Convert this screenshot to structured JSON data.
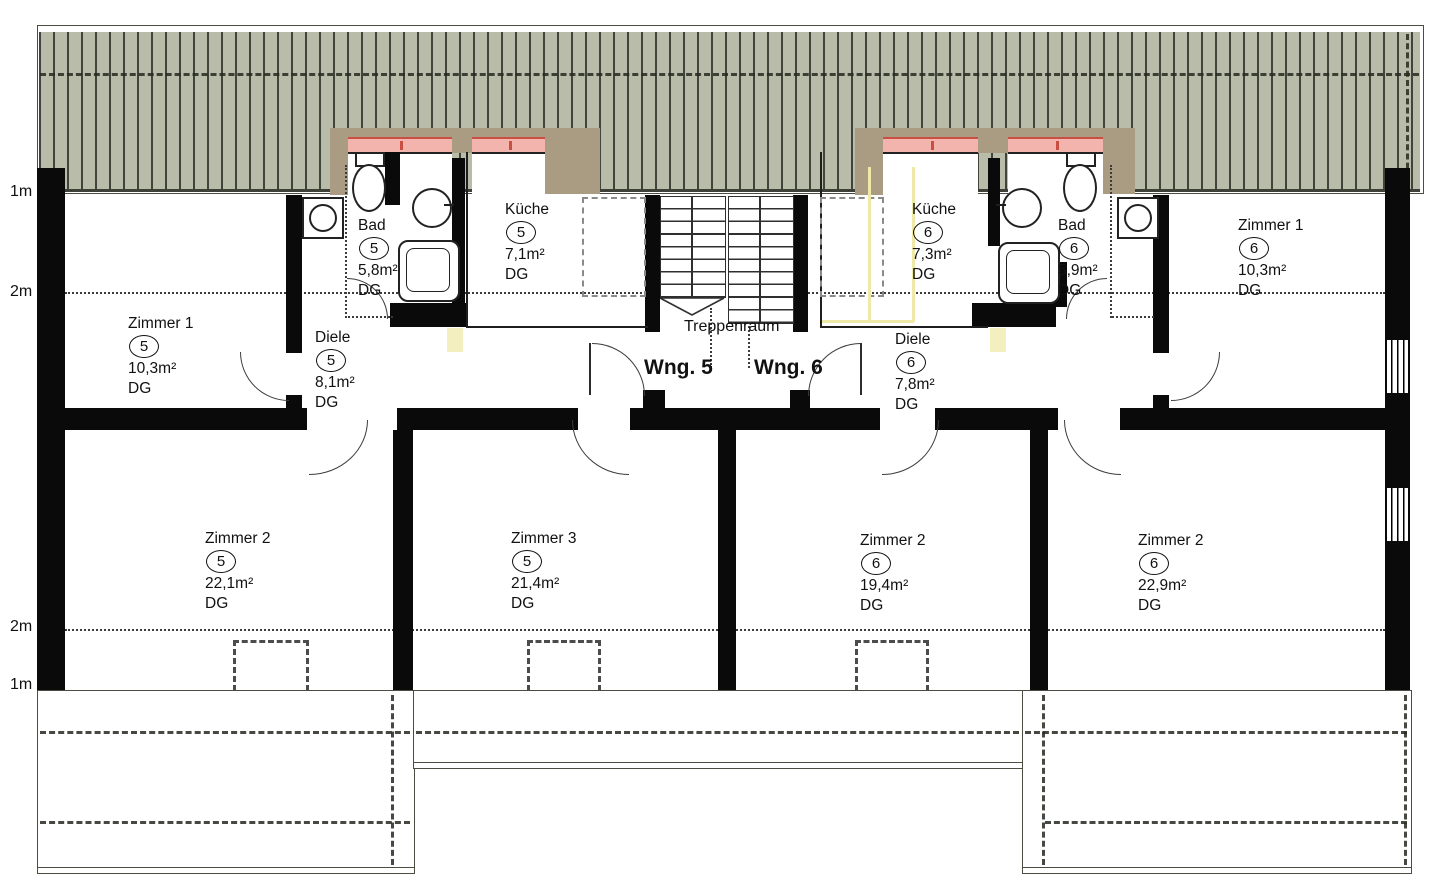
{
  "plan": {
    "stairwell_label": "Treppenraum",
    "apartment_labels": {
      "wng5": "Wng. 5",
      "wng6": "Wng. 6"
    },
    "measure_marks": {
      "top_eave": "1m",
      "top_headroom": "2m",
      "bottom_headroom": "2m",
      "bottom_eave": "1m"
    }
  },
  "rooms": [
    {
      "id": "zimmer1-wng5",
      "name": "Zimmer 1",
      "number": "5",
      "area": "10,3m²",
      "floor": "DG"
    },
    {
      "id": "bad-wng5",
      "name": "Bad",
      "number": "5",
      "area": "5,8m²",
      "floor": "DG"
    },
    {
      "id": "kueche-wng5",
      "name": "Küche",
      "number": "5",
      "area": "7,1m²",
      "floor": "DG"
    },
    {
      "id": "diele-wng5",
      "name": "Diele",
      "number": "5",
      "area": "8,1m²",
      "floor": "DG"
    },
    {
      "id": "zimmer2-wng5",
      "name": "Zimmer 2",
      "number": "5",
      "area": "22,1m²",
      "floor": "DG"
    },
    {
      "id": "zimmer3-wng5",
      "name": "Zimmer 3",
      "number": "5",
      "area": "21,4m²",
      "floor": "DG"
    },
    {
      "id": "kueche-wng6",
      "name": "Küche",
      "number": "6",
      "area": "7,3m²",
      "floor": "DG"
    },
    {
      "id": "bad-wng6",
      "name": "Bad",
      "number": "6",
      "area": "5,9m²",
      "floor": "DG"
    },
    {
      "id": "diele-wng6",
      "name": "Diele",
      "number": "6",
      "area": "7,8m²",
      "floor": "DG"
    },
    {
      "id": "zimmer1-wng6",
      "name": "Zimmer 1",
      "number": "6",
      "area": "10,3m²",
      "floor": "DG"
    },
    {
      "id": "zimmer2-wng6",
      "name": "Zimmer 2",
      "number": "6",
      "area": "19,4m²",
      "floor": "DG"
    },
    {
      "id": "zimmer2b-wng6",
      "name": "Zimmer 2",
      "number": "6",
      "area": "22,9m²",
      "floor": "DG"
    }
  ],
  "colors": {
    "roof_fill": "#b8bca8",
    "roof_line": "#41443a",
    "dormer_wall": "#a99c82",
    "window_fill": "#f2b4ac",
    "window_line": "#c94f45",
    "kitchen_mark": "#efe9a8",
    "wall": "#0a0a0a"
  }
}
